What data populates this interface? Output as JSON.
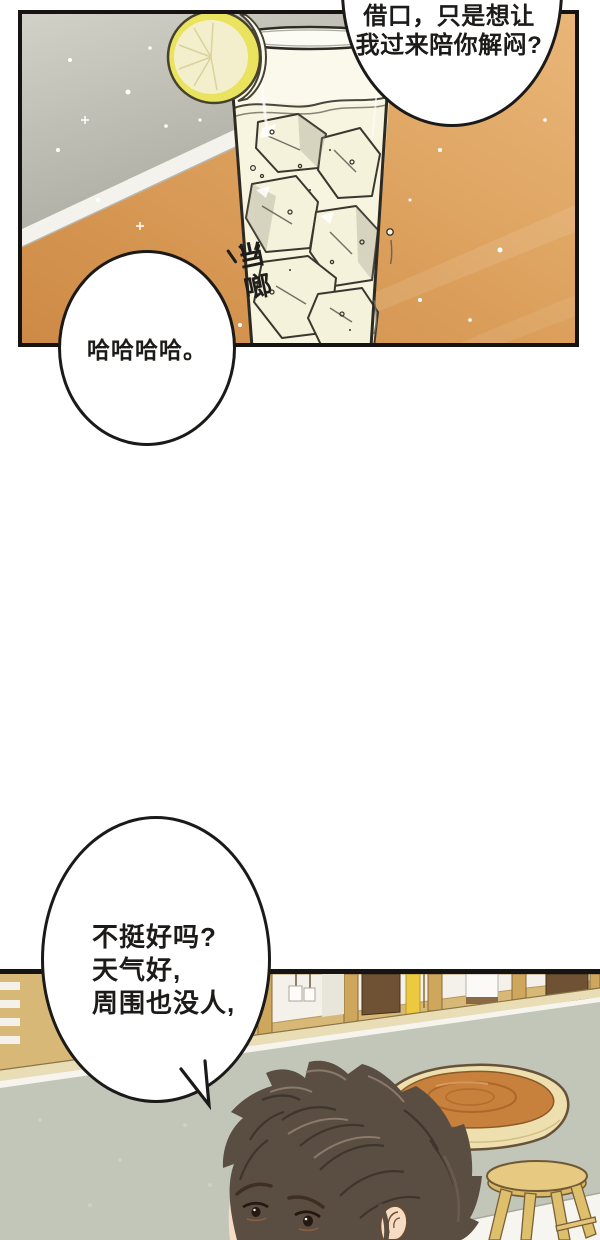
{
  "bubbles": {
    "top_right": {
      "lines": [
        "借口，只是想让",
        "我过来陪你解闷?"
      ]
    },
    "laugh": {
      "text": "哈哈哈哈。"
    },
    "weather": {
      "lines": [
        "不挺好吗?",
        "天气好,",
        "周围也没人,"
      ]
    }
  },
  "sfx": {
    "clink": "当啷"
  },
  "palette": {
    "panel_border": "#151413",
    "bubble_border": "#1b1a18",
    "text": "#1c1b19",
    "wall_top": "#d2d1c8",
    "wall_bottom": "#a3a298",
    "table_wood_light": "#e9b678",
    "table_wood_dark": "#cd8a46",
    "counter_edge": "#f4f2ec",
    "glass_fill": "#fbf9ec",
    "ice_fill": "#f4f2da",
    "ice_line": "#3a382e",
    "lemon_rind": "#eae35e",
    "lemon_flesh": "#f3efcd",
    "shelf_wood": "#d8b876",
    "shelf_post": "#cfa75c",
    "cubby_white": "#f3f1ea",
    "box_brown": "#6f5233",
    "accent_yellow": "#ecc93e",
    "wall_gray": "#c2c6b9",
    "floor_white": "#f6f5ef",
    "slab_rim": "#eedfae",
    "slab_top": "#c8803d",
    "slab_grain": "#a55f26",
    "stool_wood": "#e7c981",
    "hair": "#5a4d41",
    "skin": "#f6dcc2"
  }
}
